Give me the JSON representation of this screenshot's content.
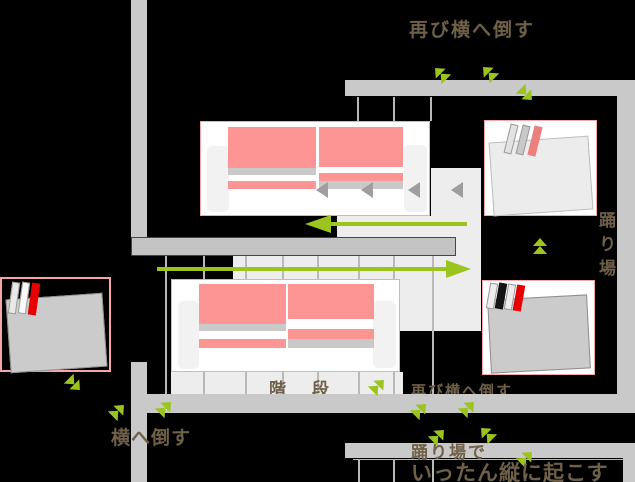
{
  "diagram_title": "sofa-moving-up-switchback-staircase",
  "labels": {
    "top_instruction": "再び横へ倒す",
    "landing_side_vertical": "踊り場",
    "stairs": "階段",
    "mid_right_instruction": "再び横へ倒す",
    "bottom_left_instruction": "横へ倒す",
    "landing_bottom_line1": "踊り場で",
    "landing_bottom_line2": "いったん縦に起こす"
  },
  "colors": {
    "accent_green": "#9cc41f",
    "cushion_pink": "#fe9595",
    "box_border_pink": "#f6a6a6",
    "wall_gray": "#c9c9c9",
    "wall_border_dark": "#454545",
    "stair_light": "#ededed",
    "tread_line": "#b9b9b9",
    "label_brown": "#6f6048",
    "stripe_red": "#e60000",
    "stripe_black": "#151515",
    "item_gray": "#cbcbcb"
  },
  "icons": {
    "move_chevron": "double-triangle-green",
    "direction_triangle": "gray-left-triangle",
    "path_arrow": "green-long-arrow"
  }
}
